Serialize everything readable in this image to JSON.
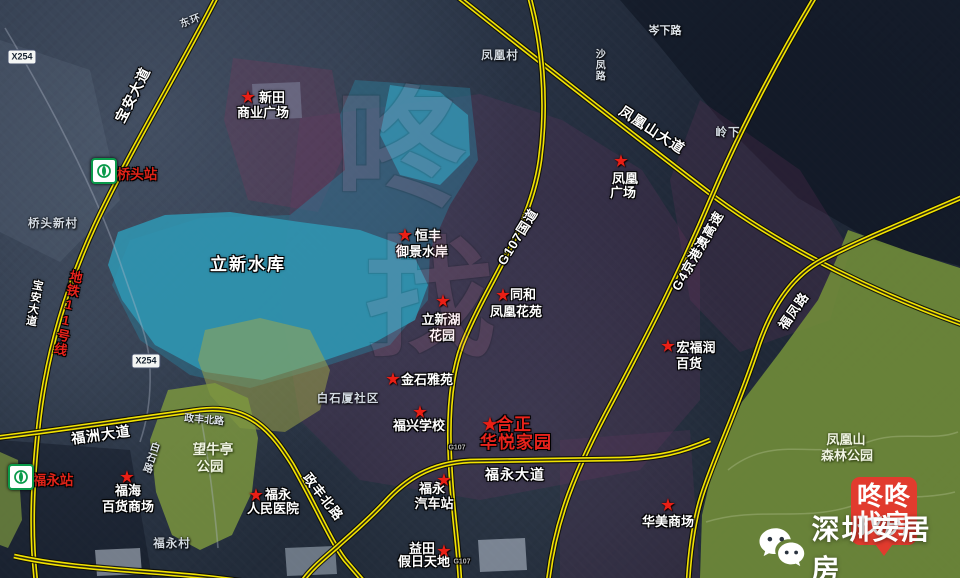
{
  "badge": {
    "line1": "咚咚",
    "line2": "找房",
    "color": "#e13b2e"
  },
  "brand": {
    "text": "深圳安居房",
    "icon": "wechat-icon"
  },
  "colors": {
    "road_yellow": "#f2e300",
    "star_red": "#ea1f15",
    "badge_red": "#e13b2e",
    "metro_green": "#0a9a4a",
    "water_teal": "#2f98b4",
    "park_green": "#7e924a"
  },
  "map": {
    "marker_glyph": "★",
    "overlays": [
      {
        "n": "terrain-light-left",
        "pts": "0,40 90,70 120,200 60,262 0,232",
        "f": "rgba(160,172,192,0.10)"
      },
      {
        "n": "dark-mountain-ne",
        "pts": "620,0 960,0 960,266 878,244 798,198 718,118 658,44",
        "f": "rgba(7,13,26,0.5)"
      },
      {
        "n": "tint-xintian",
        "pts": "233,58 332,70 346,150 318,212 248,200 224,120",
        "f": "rgba(133,56,92,0.26)"
      },
      {
        "n": "tint-center",
        "pts": "300,118 480,94 562,120 642,170 700,260 700,400 640,470 480,500 360,480 300,420 280,300",
        "f": "rgba(116,56,102,0.22)"
      },
      {
        "n": "tint-right",
        "pts": "700,100 800,170 850,250 830,320 740,352 690,300 670,180",
        "f": "rgba(118,56,100,0.20)"
      },
      {
        "n": "tint-bottom-right",
        "pts": "560,440 690,430 700,578 560,578",
        "f": "rgba(112,54,98,0.20)"
      },
      {
        "n": "dark-bottom-left",
        "pts": "0,440 130,450 152,578 0,578",
        "f": "rgba(10,16,30,0.38)"
      },
      {
        "n": "reservoir-overlay",
        "pts": "355,80 470,88 478,160 450,205 430,250 428,300 390,345 320,368 250,388 190,375 140,340 112,285 130,240 200,218 290,215 345,170 340,115",
        "f": "rgba(42,126,156,0.45)"
      },
      {
        "n": "lixin-reservoir",
        "pts": "118,232 165,215 230,212 300,222 360,230 410,248 428,285 415,320 370,345 320,362 262,380 205,372 155,345 122,300 108,265",
        "f": "rgba(47,152,180,0.85)"
      },
      {
        "n": "reservoir-upper",
        "pts": "390,85 440,92 468,115 470,155 440,185 400,175 380,135",
        "f": "rgba(52,162,192,0.65)"
      },
      {
        "n": "olive-area",
        "pts": "205,330 260,318 310,330 330,370 320,410 285,432 240,428 210,395 198,360",
        "f": "rgba(164,170,72,0.5)"
      },
      {
        "n": "wangniuting-park",
        "pts": "168,390 215,383 248,398 258,438 252,492 232,535 200,550 172,535 156,492 150,440",
        "f": "rgba(126,152,62,0.82)"
      },
      {
        "n": "park-left-strip",
        "pts": "0,452 18,460 22,520 8,548 0,545",
        "f": "rgba(126,152,62,0.7)"
      },
      {
        "n": "fenghuangshan-forest-park",
        "pts": "848,230 910,252 960,268 960,578 700,578 702,515 716,455 742,402 780,352 818,300 836,260",
        "f": "rgba(118,146,58,0.85)"
      },
      {
        "n": "bright-roof-1",
        "pts": "95,550 140,548 142,574 97,576",
        "f": "rgba(208,218,230,0.5)"
      },
      {
        "n": "bright-roof-2",
        "pts": "285,548 335,546 337,574 287,576",
        "f": "rgba(200,212,226,0.45)"
      },
      {
        "n": "bright-roof-3",
        "pts": "478,540 525,538 527,570 480,572",
        "f": "rgba(205,215,230,0.5)"
      },
      {
        "n": "bright-roof-4",
        "pts": "252,84 300,82 302,118 254,120",
        "f": "rgba(168,190,214,0.30)"
      }
    ],
    "roads": [
      {
        "name": "road-baoan-avenue",
        "d": "M 218,-6 C 185,60 130,150 95,225 C 65,290 45,360 38,430 C 33,480 30,530 36,582"
      },
      {
        "name": "road-fenghuangshan-avenue",
        "d": "M 452,-8 C 540,62 640,140 716,198 C 790,252 880,295 965,325"
      },
      {
        "name": "road-g4-expressway",
        "d": "M 818,-8 C 780,55 740,130 712,196 C 680,272 650,330 613,400 C 575,470 555,520 548,582"
      },
      {
        "name": "road-g107",
        "d": "M 528,-8 C 542,40 548,100 540,160 C 530,230 488,280 462,345 C 450,378 448,420 450,460 C 452,510 458,540 460,582"
      },
      {
        "name": "road-fuzhou-zhengfeng",
        "d": "M -6,438 C 60,430 140,418 200,410 C 250,404 272,432 292,464 C 316,506 330,540 345,560 L 364,582"
      },
      {
        "name": "road-fuyong-avenue",
        "d": "M 710,440 C 682,452 660,458 620,459 L 470,461 C 430,463 405,480 385,502 C 365,523 350,535 337,547 C 322,560 310,570 302,582"
      },
      {
        "name": "road-fufeng",
        "d": "M 965,196 C 910,220 860,240 822,260 C 790,277 770,310 757,350 C 735,415 715,455 702,495 C 694,520 690,548 688,582"
      },
      {
        "name": "road-bottom-link",
        "d": "M 14,556 C 85,572 175,570 258,584"
      }
    ],
    "minor_roads": [
      {
        "name": "road-x254-county",
        "d": "M 5,28 C 45,95 92,182 120,262 C 138,316 150,342 150,370 C 151,402 146,424 140,442"
      },
      {
        "name": "road-village-lane",
        "d": "M 200,412 C 208,456 214,500 218,548"
      }
    ],
    "trails": [
      {
        "name": "park-trail-1",
        "d": "M 728,470 C 775,432 820,462 868,442 C 900,430 932,442 958,432"
      },
      {
        "name": "park-trail-2",
        "d": "M 706,522 C 758,506 802,522 852,506 C 888,494 925,500 955,492"
      }
    ],
    "stars": [
      {
        "n": "xintian-plaza-star",
        "x": 248,
        "y": 97
      },
      {
        "n": "hengfeng-star",
        "x": 405,
        "y": 235
      },
      {
        "n": "tonghe-star",
        "x": 503,
        "y": 295
      },
      {
        "n": "lixinhu-garden-star",
        "x": 443,
        "y": 301
      },
      {
        "n": "fenghuang-plaza-star",
        "x": 621,
        "y": 161
      },
      {
        "n": "jinshi-yayuan-star",
        "x": 393,
        "y": 379
      },
      {
        "n": "fuxing-school-star",
        "x": 420,
        "y": 412
      },
      {
        "n": "hezheng-star",
        "x": 490,
        "y": 425,
        "s": 17
      },
      {
        "n": "hongfurun-star",
        "x": 668,
        "y": 346
      },
      {
        "n": "fuhai-star",
        "x": 127,
        "y": 477
      },
      {
        "n": "fuyong-hospital-star",
        "x": 256,
        "y": 495
      },
      {
        "n": "fuyong-bus-station-star",
        "x": 444,
        "y": 480
      },
      {
        "n": "yitian-star",
        "x": 444,
        "y": 551
      },
      {
        "n": "huamei-mall-star",
        "x": 668,
        "y": 505
      }
    ],
    "shields": [
      {
        "n": "shield-x254-north",
        "t": "X254",
        "x": 22,
        "y": 57
      },
      {
        "n": "shield-x254-south",
        "t": "X254",
        "x": 146,
        "y": 361
      }
    ],
    "stations": [
      {
        "n": "qiaotou-station-logo",
        "x": 104,
        "y": 171
      },
      {
        "n": "fuyong-station-logo",
        "x": 21,
        "y": 477
      }
    ],
    "labels": [
      {
        "t": "新田",
        "x": 272,
        "y": 98,
        "c": "poi",
        "n": "xintian-plaza-label-1"
      },
      {
        "t": "商业广场",
        "x": 263,
        "y": 113,
        "c": "poi",
        "n": "xintian-plaza-label-2"
      },
      {
        "t": "恒丰",
        "x": 428,
        "y": 236,
        "c": "poi",
        "n": "hengfeng-label-1"
      },
      {
        "t": "御景水岸",
        "x": 422,
        "y": 252,
        "c": "poi",
        "n": "hengfeng-label-2"
      },
      {
        "t": "同和",
        "x": 523,
        "y": 295,
        "c": "poi",
        "n": "tonghe-label-1"
      },
      {
        "t": "凤凰花苑",
        "x": 516,
        "y": 312,
        "c": "poi",
        "n": "tonghe-label-2"
      },
      {
        "t": "立新湖",
        "x": 441,
        "y": 320,
        "c": "poi",
        "n": "lixinhu-garden-label-1"
      },
      {
        "t": "花园",
        "x": 442,
        "y": 336,
        "c": "poi",
        "n": "lixinhu-garden-label-2"
      },
      {
        "t": "金石雅苑",
        "x": 427,
        "y": 380,
        "c": "poi",
        "n": "jinshi-yayuan-label"
      },
      {
        "t": "凤凰",
        "x": 625,
        "y": 179,
        "c": "poi",
        "n": "fenghuang-plaza-label-1"
      },
      {
        "t": "广场",
        "x": 623,
        "y": 193,
        "c": "poi",
        "n": "fenghuang-plaza-label-2"
      },
      {
        "t": "宏福润",
        "x": 696,
        "y": 348,
        "c": "poi",
        "n": "hongfurun-label-1"
      },
      {
        "t": "百货",
        "x": 689,
        "y": 364,
        "c": "poi",
        "n": "hongfurun-label-2"
      },
      {
        "t": "福兴学校",
        "x": 419,
        "y": 426,
        "c": "poi",
        "n": "fuxing-school-label"
      },
      {
        "t": "福海",
        "x": 128,
        "y": 491,
        "c": "poi",
        "n": "fuhai-label-1"
      },
      {
        "t": "百货商场",
        "x": 128,
        "y": 507,
        "c": "poi",
        "n": "fuhai-label-2"
      },
      {
        "t": "福永",
        "x": 278,
        "y": 495,
        "c": "poi",
        "n": "fuyong-hospital-label-1"
      },
      {
        "t": "人民医院",
        "x": 273,
        "y": 509,
        "c": "poi",
        "n": "fuyong-hospital-label-2"
      },
      {
        "t": "福永",
        "x": 432,
        "y": 489,
        "c": "poi",
        "n": "fuyong-bus-label-1"
      },
      {
        "t": "汽车站",
        "x": 434,
        "y": 504,
        "c": "poi",
        "n": "fuyong-bus-label-2"
      },
      {
        "t": "益田",
        "x": 422,
        "y": 549,
        "c": "poi",
        "n": "yitian-label-1"
      },
      {
        "t": "假日天地",
        "x": 424,
        "y": 562,
        "c": "poi",
        "n": "yitian-label-2"
      },
      {
        "t": "华美商场",
        "x": 668,
        "y": 522,
        "c": "poi",
        "n": "huamei-mall-label"
      },
      {
        "t": "合正",
        "x": 514,
        "y": 425,
        "c": "poi-red",
        "n": "hezheng-huayue-label-1"
      },
      {
        "t": "华悦家园",
        "x": 516,
        "y": 443,
        "c": "poi-red",
        "n": "hezheng-huayue-label-2"
      },
      {
        "t": "桥头站",
        "x": 137,
        "y": 175,
        "c": "station",
        "n": "qiaotou-station-label"
      },
      {
        "t": "福永站",
        "x": 53,
        "y": 481,
        "c": "station",
        "n": "fuyong-station-label"
      },
      {
        "t": "地铁11号线",
        "x": 67,
        "y": 313,
        "c": "metro-line",
        "v": 1,
        "r": 12,
        "n": "metro-line-11-label"
      },
      {
        "t": "立新水库",
        "x": 248,
        "y": 265,
        "c": "water",
        "n": "lixin-reservoir-label"
      },
      {
        "t": "望牛亭",
        "x": 213,
        "y": 450,
        "c": "park",
        "n": "wangniuting-park-label-1"
      },
      {
        "t": "公园",
        "x": 210,
        "y": 467,
        "c": "park",
        "n": "wangniuting-park-label-2"
      },
      {
        "t": "凤凰山",
        "x": 846,
        "y": 440,
        "c": "park",
        "s": 13,
        "n": "fenghuangshan-park-label-1"
      },
      {
        "t": "森林公园",
        "x": 847,
        "y": 456,
        "c": "park",
        "s": 13,
        "n": "fenghuangshan-park-label-2"
      },
      {
        "t": "凤凰村",
        "x": 500,
        "y": 56,
        "c": "town",
        "n": "fenghuang-village-label"
      },
      {
        "t": "岭下",
        "x": 728,
        "y": 133,
        "c": "town",
        "n": "lingxia-label"
      },
      {
        "t": "桥头新村",
        "x": 53,
        "y": 224,
        "c": "town",
        "n": "qiaotou-xincun-label"
      },
      {
        "t": "白石厦社区",
        "x": 348,
        "y": 399,
        "c": "town",
        "n": "baishixia-community-label"
      },
      {
        "t": "福永村",
        "x": 172,
        "y": 544,
        "c": "town",
        "n": "fuyong-village-label"
      },
      {
        "t": "东环",
        "x": 191,
        "y": 22,
        "c": "town",
        "s": 10,
        "r": -20,
        "n": "donghuan-label"
      },
      {
        "t": "宝安大道",
        "x": 133,
        "y": 95,
        "c": "road outl",
        "r": -63,
        "n": "baoan-avenue-label"
      },
      {
        "t": "宝安大道",
        "x": 33,
        "y": 303,
        "c": "road outl",
        "v": 1,
        "r": 10,
        "s": 11,
        "n": "baoan-avenue-label-2"
      },
      {
        "t": "凤凰山大道",
        "x": 652,
        "y": 130,
        "c": "road outl",
        "r": 33,
        "n": "fenghuangshan-avenue-label"
      },
      {
        "t": "G4京港澳高速",
        "x": 698,
        "y": 251,
        "c": "road outl",
        "r": -60,
        "s": 13,
        "n": "g4-expressway-label"
      },
      {
        "t": "G107国道",
        "x": 518,
        "y": 237,
        "c": "road outl",
        "r": -58,
        "s": 13,
        "n": "g107-national-road-label"
      },
      {
        "t": "福凤路",
        "x": 794,
        "y": 311,
        "c": "road outl",
        "r": -55,
        "s": 13,
        "n": "fufeng-road-label"
      },
      {
        "t": "福洲大道",
        "x": 101,
        "y": 435,
        "c": "road outl",
        "r": -8,
        "n": "fuzhou-avenue-label"
      },
      {
        "t": "福永大道",
        "x": 515,
        "y": 475,
        "c": "road outl",
        "r": 0,
        "n": "fuyong-avenue-label"
      },
      {
        "t": "政丰北路",
        "x": 323,
        "y": 497,
        "c": "road outl",
        "r": 52,
        "s": 13,
        "n": "zhengfeng-north-road-label"
      },
      {
        "t": "政丰北路",
        "x": 204,
        "y": 421,
        "c": "road-sm",
        "r": 5,
        "n": "zhengfeng-north-road-label-2"
      },
      {
        "t": "沙凤路",
        "x": 598,
        "y": 65,
        "c": "road-sm",
        "v": 1,
        "n": "shafeng-road-label"
      },
      {
        "t": "岑下路",
        "x": 665,
        "y": 32,
        "c": "road-sm",
        "s": 11,
        "n": "cenxia-road-label"
      },
      {
        "t": "白石路",
        "x": 149,
        "y": 457,
        "c": "road-sm",
        "v": 1,
        "r": 18,
        "n": "baishi-road-label"
      },
      {
        "t": "G107",
        "x": 457,
        "y": 448,
        "c": "road-tiny",
        "n": "g107-road-text-1"
      },
      {
        "t": "G107",
        "x": 462,
        "y": 562,
        "c": "road-tiny",
        "n": "g107-road-text-2"
      },
      {
        "t": "咚",
        "x": 400,
        "y": 150,
        "c": "ghost",
        "n": "watermark-ghost-1"
      },
      {
        "t": "找",
        "x": 430,
        "y": 300,
        "c": "ghost",
        "n": "watermark-ghost-2"
      }
    ]
  }
}
